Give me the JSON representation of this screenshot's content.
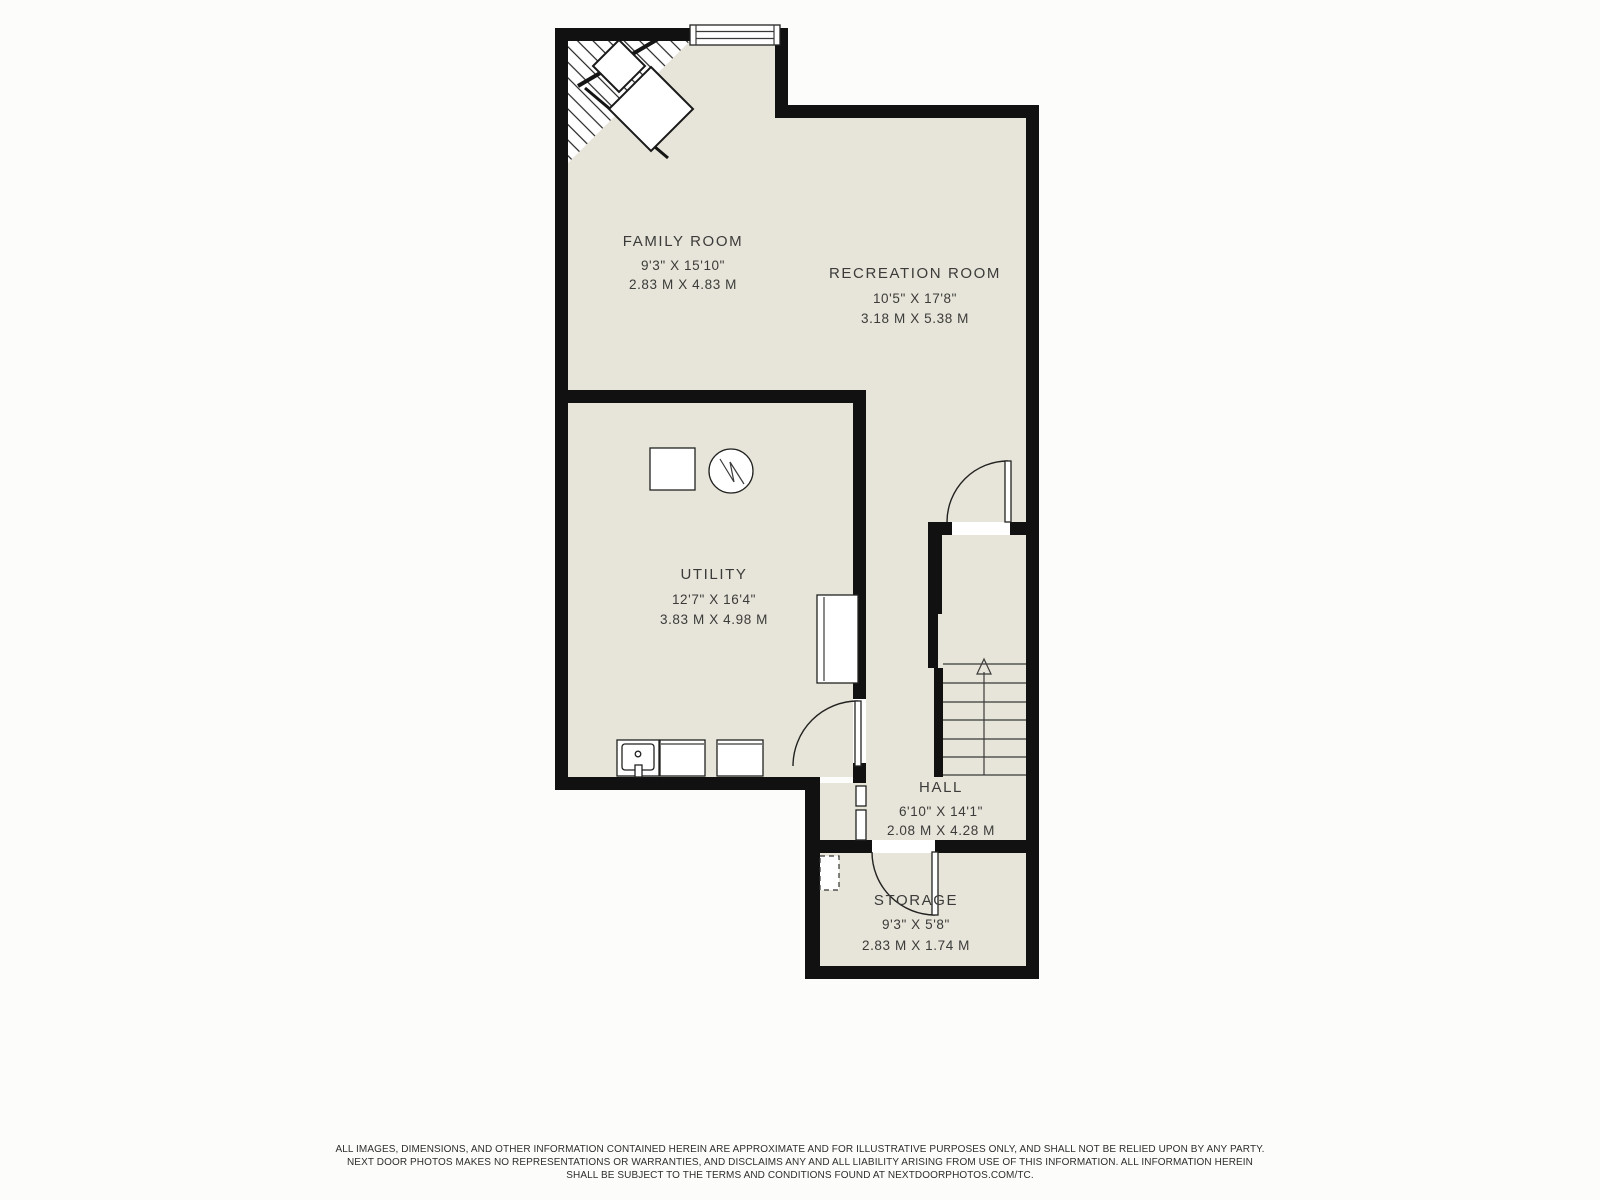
{
  "page": {
    "background": "#fcfcfa"
  },
  "floorplan": {
    "colors": {
      "floor": "#e7e5da",
      "wall": "#111111",
      "line": "#3a3a38",
      "label": "#3b3b39",
      "background": "#fcfcfa"
    },
    "rooms": [
      {
        "name": "FAMILY ROOM",
        "imperial": "9'3\" X 15'10\"",
        "metric": "2.83 M X 4.83 M"
      },
      {
        "name": "RECREATION ROOM",
        "imperial": "10'5\" X 17'8\"",
        "metric": "3.18 M X 5.38 M"
      },
      {
        "name": "UTILITY",
        "imperial": "12'7\" X 16'4\"",
        "metric": "3.83 M X 4.98 M"
      },
      {
        "name": "HALL",
        "imperial": "6'10\" X 14'1\"",
        "metric": "2.08 M X 4.28 M"
      },
      {
        "name": "STORAGE",
        "imperial": "9'3\" X 5'8\"",
        "metric": "2.83 M X 1.74 M"
      }
    ],
    "icons": [
      "stairs-up-arrow-icon",
      "window-icon",
      "door-swing-icon",
      "water-heater-icon",
      "electrical-panel-icon",
      "laundry-sink-icon",
      "washer-icon",
      "dryer-icon",
      "corner-stairs-icon",
      "crawlspace-access-icon"
    ]
  },
  "disclaimer": {
    "line1": "ALL IMAGES, DIMENSIONS, AND OTHER INFORMATION CONTAINED HEREIN ARE APPROXIMATE AND FOR ILLUSTRATIVE PURPOSES ONLY, AND SHALL NOT BE RELIED UPON BY ANY PARTY.",
    "line2": "NEXT DOOR PHOTOS MAKES NO REPRESENTATIONS OR WARRANTIES, AND DISCLAIMS ANY AND ALL LIABILITY ARISING FROM USE OF THIS INFORMATION. ALL INFORMATION HEREIN",
    "line3": "SHALL BE SUBJECT TO THE TERMS AND CONDITIONS FOUND AT NEXTDOORPHOTOS.COM/TC."
  }
}
